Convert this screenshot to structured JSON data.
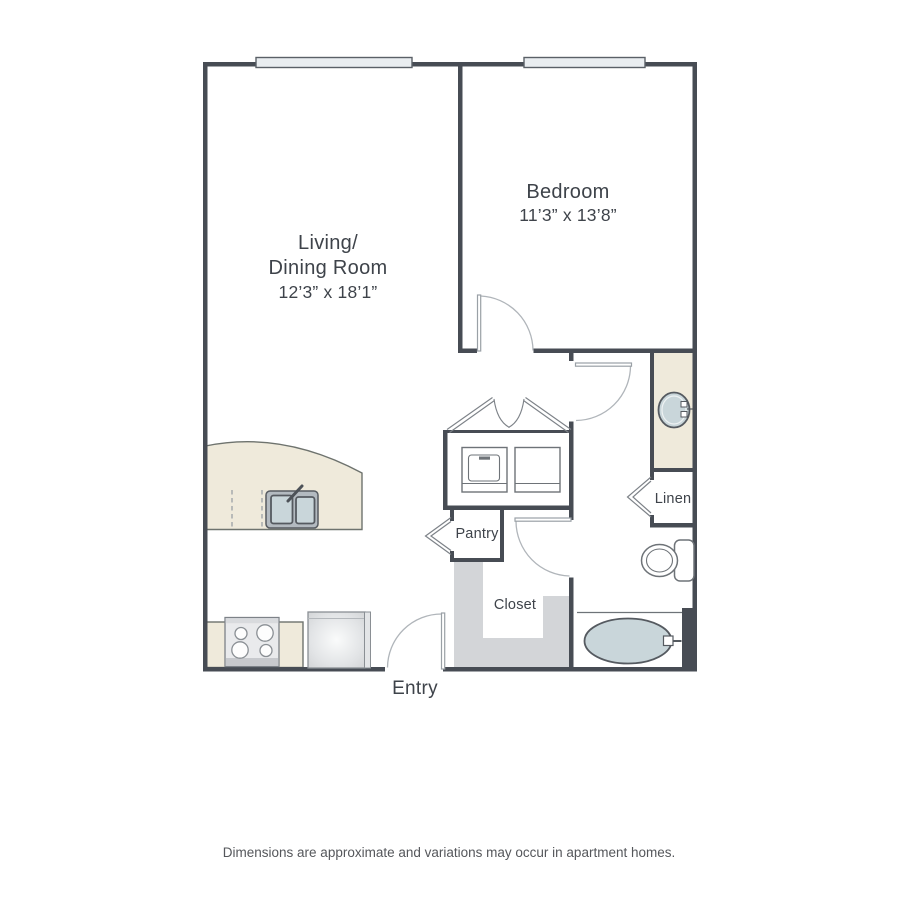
{
  "colors": {
    "wall": "#474c54",
    "counter": "#efeadb",
    "fixture": "#c9d6da",
    "closet-fill": "#d3d5d8",
    "window-fill": "#e9edf0",
    "door-line": "#9aa0a6",
    "label": "#3e434a",
    "footer-text": "#55575b"
  },
  "floor_plan": {
    "rooms": {
      "living_dining": {
        "name_line1": "Living/",
        "name_line2": "Dining Room",
        "dimensions": "12’3” x 18’1”"
      },
      "bedroom": {
        "name": "Bedroom",
        "dimensions": "11’3” x 13’8”"
      },
      "pantry": {
        "name": "Pantry"
      },
      "closet": {
        "name": "Closet"
      },
      "linen": {
        "name": "Linen"
      },
      "entry": {
        "name": "Entry"
      }
    },
    "fixture_icons": [
      "washer-icon",
      "dryer-icon",
      "kitchen-sink-icon",
      "stove-icon",
      "refrigerator-icon",
      "bathroom-sink-icon",
      "toilet-icon",
      "bathtub-icon",
      "window-icon",
      "door-swing-icon",
      "bifold-door-icon",
      "closet-door-chevron-icon"
    ]
  },
  "footer": {
    "disclaimer": "Dimensions are approximate and variations may occur in apartment homes."
  }
}
